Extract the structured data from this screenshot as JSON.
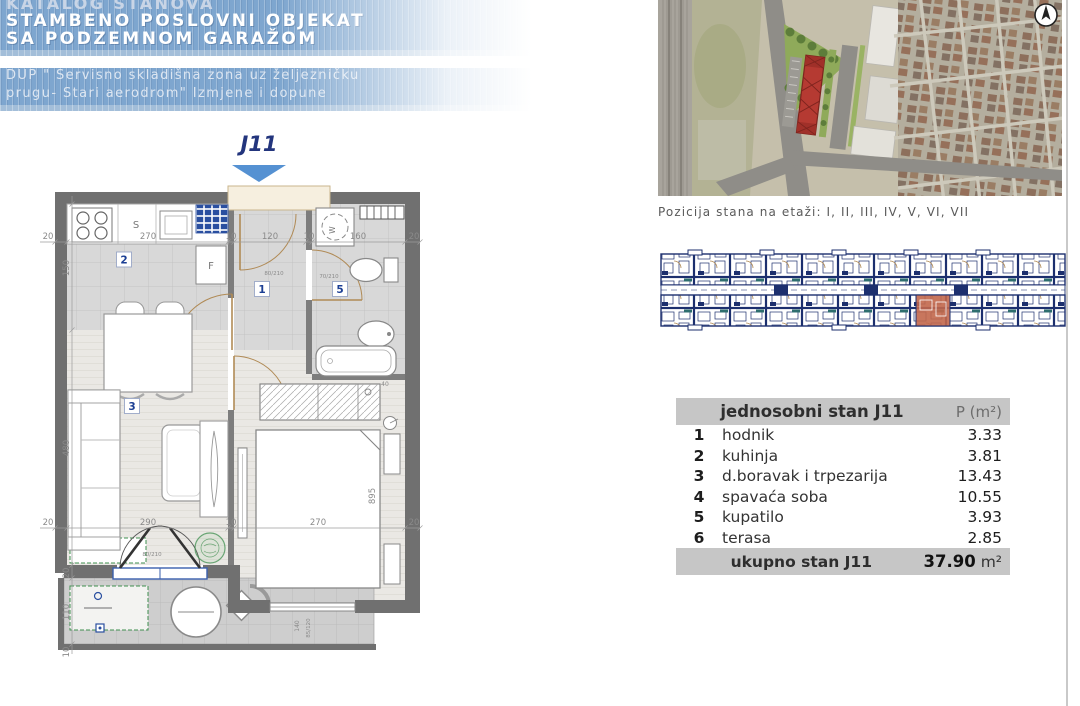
{
  "header": {
    "catalog_title": "KATALOG STANOVA",
    "building_title_line1": "STAMBENO POSLOVNI OBJEKAT",
    "building_title_line2": "SA PODZEMNOM GARAŽOM",
    "plan_subtitle_line1": "DUP \" Servisno skladišna zona uz željezničku",
    "plan_subtitle_line2": "prugu- Stari aerodrom\" Izmjene i dopune"
  },
  "floor_plan": {
    "unit_label": "J11",
    "room_numbers": {
      "hodnik": "1",
      "kuhinja": "2",
      "dnevni_boravak": "3",
      "kupatilo": "5"
    },
    "fixture_labels": {
      "sink": "S",
      "fridge": "F",
      "washer": "W"
    },
    "dimensions": {
      "d20": "20",
      "d10": "10",
      "d270": "270",
      "d120": "120",
      "d160": "160",
      "d150": "150",
      "d290": "290",
      "d480": "480",
      "d110": "110",
      "d895": "895",
      "d140": "140",
      "d40": "40",
      "door_main": "80/210",
      "door_bath": "70/210",
      "window_spec": "85/120"
    }
  },
  "location": {
    "caption": "Pozicija stana na etaži: I, II, III, IV, V, VI, VII"
  },
  "table": {
    "title": "jednosobni stan J11",
    "area_header": "P (m²)",
    "rows": [
      {
        "num": "1",
        "name": "hodnik",
        "area": "3.33"
      },
      {
        "num": "2",
        "name": "kuhinja",
        "area": "3.81"
      },
      {
        "num": "3",
        "name": "d.boravak i trpezarija",
        "area": "13.43"
      },
      {
        "num": "4",
        "name": "spavaća soba",
        "area": "10.55"
      },
      {
        "num": "5",
        "name": "kupatilo",
        "area": "3.93"
      },
      {
        "num": "6",
        "name": "terasa",
        "area": "2.85"
      }
    ],
    "total_label": "ukupno stan J11",
    "total_value": "37.90",
    "total_unit": "m²"
  },
  "colors": {
    "header_blue": "#7ea6cf",
    "accent_navy": "#23357d",
    "arrow_blue": "#5591d2",
    "highlight_orange": "#c2674b",
    "table_band_gray": "#c6c6c6",
    "wall_gray": "#707070",
    "strip_navy": "#1c2f6e",
    "stamp_green": "#3f8f4f"
  }
}
